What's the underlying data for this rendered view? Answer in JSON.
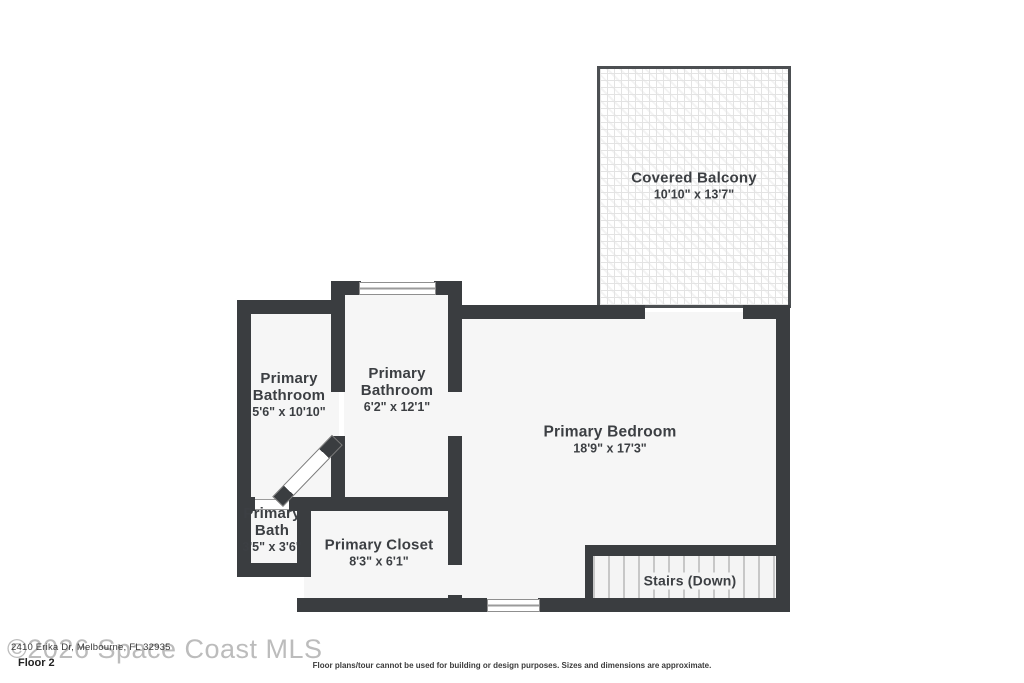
{
  "colors": {
    "wall": "#3a3d40",
    "fill": "#f6f6f6",
    "text": "#3c3f43",
    "watermark": "#bcbcbc",
    "balcony_pattern": "#e3e3e3",
    "stair_tread": "#c7c7c7"
  },
  "rooms": {
    "balcony": {
      "name": "Covered Balcony",
      "dims": "10'10\" x 13'7\""
    },
    "bathroom_left": {
      "name": "Primary Bathroom",
      "dims": "5'6\" x 10'10\""
    },
    "bathroom_mid": {
      "name": "Primary Bathroom",
      "dims": "6'2\" x 12'1\""
    },
    "bedroom": {
      "name": "Primary Bedroom",
      "dims": "18'9\" x 17'3\""
    },
    "bath": {
      "name": "Primary Bath",
      "dims": "3'5\" x 3'6\""
    },
    "closet": {
      "name": "Primary Closet",
      "dims": "8'3\" x 6'1\""
    },
    "stairs": {
      "name": "Stairs (Down)"
    }
  },
  "footer": {
    "watermark": "©2026 Space Coast MLS",
    "address": "2410 Erika Dr, Melbourne, FL 32935",
    "floor": "Floor 2",
    "disclaimer": "Floor plans/tour cannot be used for building or design purposes. Sizes and dimensions are approximate."
  }
}
